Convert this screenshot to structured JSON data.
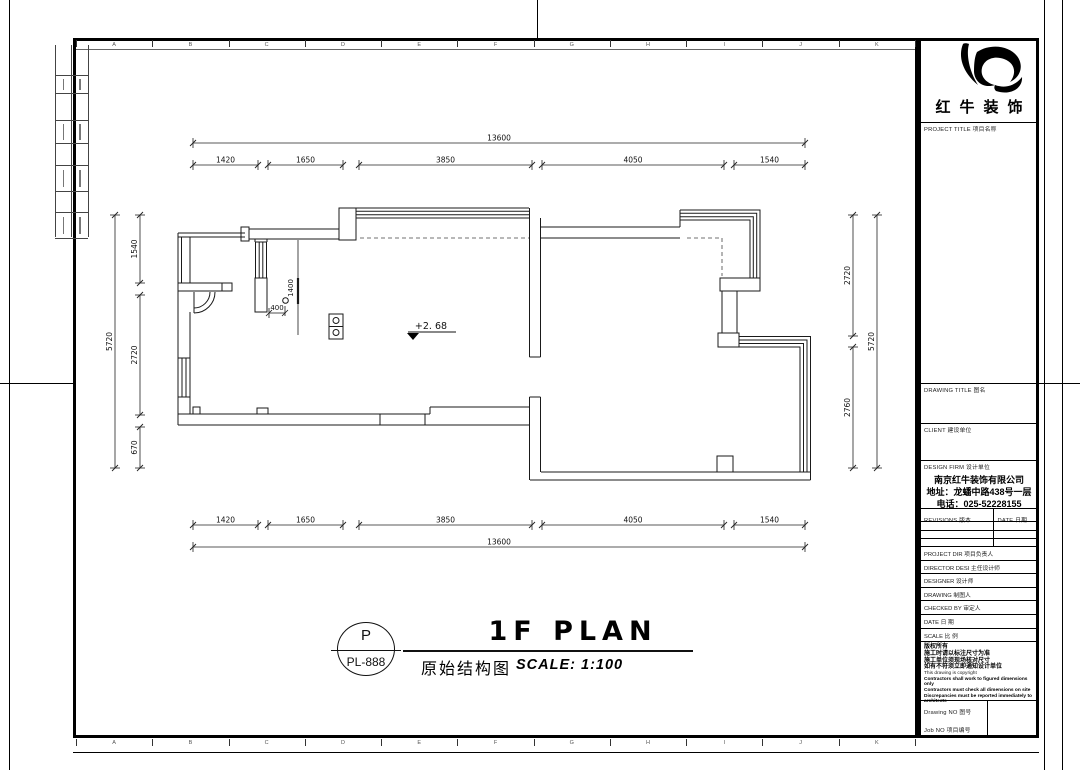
{
  "sheet": {
    "grid_letters": [
      "A",
      "B",
      "C",
      "D",
      "E",
      "F",
      "G",
      "H",
      "I",
      "J",
      "K"
    ]
  },
  "logo": {
    "company_name": "红牛装饰"
  },
  "titleblock": {
    "project_title_label": "PROJECT TITLE  项目名称",
    "drawing_title_label": "DRAWING TITLE  图名",
    "client_label": "CLIENT  建设单位",
    "design_firm_label": "DESIGN FIRM  设计单位",
    "design_firm_lines": [
      "南京红牛装饰有限公司",
      "地址：龙蟠中路438号一层",
      "电话：025-52228155"
    ],
    "revisions_label": "REVISIONS  版本",
    "revisions_date_label": "DATE  日期",
    "staff_rows": [
      "PROJECT DIR    项目负责人",
      "DIRECTOR DESI  主任设计师",
      "DESIGNER       设计师",
      "DRAWING        制图人",
      "CHECKED BY     审定人",
      "DATE           日  期",
      "SCALE          比  例"
    ],
    "notes_cn": [
      "版权所有",
      "施工时请以标注尺寸为准",
      "施工单位须现场核对尺寸",
      "如有不符须立即通知设计单位"
    ],
    "notes_en": [
      "This drawing is copyright",
      "Contractors shall work to figured dimensions only",
      "Contractors must check all dimensions on site",
      "Discrepancies must be reported immediately to architects"
    ],
    "drawing_no_label": "Drawing NO 图号",
    "job_no_label": "Job NO  项目编号"
  },
  "plan_title": {
    "bubble_letter": "P",
    "bubble_code": "PL-888",
    "title": "1F PLAN",
    "subtitle_cn": "原始结构图",
    "scale": "SCALE: 1:100"
  },
  "plan": {
    "level_marker": "+2. 68",
    "dims": {
      "top_overall": "13600",
      "top_segments": [
        "1420",
        "1650",
        "3850",
        "4050",
        "1540"
      ],
      "bottom_overall": "13600",
      "bottom_segments": [
        "1420",
        "1650",
        "3850",
        "4050",
        "1540"
      ],
      "left_overall": "5720",
      "left_segments": [
        "1540",
        "2720",
        "670"
      ],
      "right_overall": "5720",
      "right_segments": [
        "2720",
        "2760"
      ],
      "interior": [
        "1400",
        "400"
      ]
    }
  }
}
